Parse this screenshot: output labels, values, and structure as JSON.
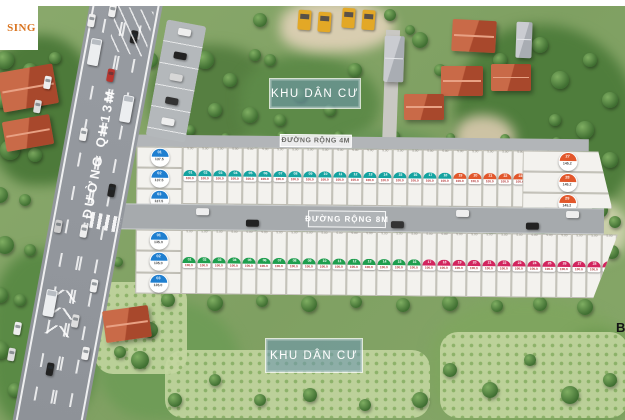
{
  "watermark": {
    "text": "SING"
  },
  "area_labels": {
    "residential_top": "KHU DÂN CƯ",
    "residential_bottom": "KHU DÂN CƯ"
  },
  "roads": {
    "main": "ĐƯỜNG QH13M",
    "internal_4m": "ĐƯỜNG RỘNG 4M",
    "internal_8m": "ĐƯỜNG RỘNG 8M"
  },
  "map_note": {
    "corner_letter": "B"
  },
  "lot_dimensions": {
    "frontage": "5.00",
    "depth": "20.0"
  },
  "palette": {
    "teal": "#14a3a0",
    "orange": "#e2572b",
    "green": "#1f9e4e",
    "pink": "#d2255e",
    "blue": "#1f7fd0",
    "area_text": "#b03030"
  },
  "blocks": {
    "upper": {
      "left_lots": [
        {
          "id": "01",
          "area": "137.5"
        },
        {
          "id": "02",
          "area": "137.5"
        },
        {
          "id": "03",
          "area": "137.5"
        }
      ],
      "row_lots": [
        {
          "id": "01",
          "area": "100.0",
          "color": "teal"
        },
        {
          "id": "02",
          "area": "100.0",
          "color": "teal"
        },
        {
          "id": "03",
          "area": "100.0",
          "color": "teal"
        },
        {
          "id": "04",
          "area": "100.0",
          "color": "teal"
        },
        {
          "id": "05",
          "area": "100.0",
          "color": "teal"
        },
        {
          "id": "06",
          "area": "100.0",
          "color": "teal"
        },
        {
          "id": "07",
          "area": "100.0",
          "color": "teal"
        },
        {
          "id": "08",
          "area": "100.0",
          "color": "teal"
        },
        {
          "id": "09",
          "area": "100.0",
          "color": "teal"
        },
        {
          "id": "10",
          "area": "100.0",
          "color": "teal"
        },
        {
          "id": "11",
          "area": "100.0",
          "color": "teal"
        },
        {
          "id": "12",
          "area": "100.0",
          "color": "teal"
        },
        {
          "id": "13",
          "area": "100.0",
          "color": "teal"
        },
        {
          "id": "14",
          "area": "100.0",
          "color": "teal"
        },
        {
          "id": "15",
          "area": "100.0",
          "color": "teal"
        },
        {
          "id": "16",
          "area": "100.0",
          "color": "teal"
        },
        {
          "id": "17",
          "area": "100.0",
          "color": "teal"
        },
        {
          "id": "18",
          "area": "100.0",
          "color": "teal"
        },
        {
          "id": "19",
          "area": "100.0",
          "color": "orange"
        },
        {
          "id": "20",
          "area": "100.0",
          "color": "orange"
        },
        {
          "id": "21",
          "area": "100.0",
          "color": "orange"
        },
        {
          "id": "22",
          "area": "100.0",
          "color": "orange"
        },
        {
          "id": "23",
          "area": "100.0",
          "color": "orange"
        },
        {
          "id": "24",
          "area": "100.0",
          "color": "orange"
        },
        {
          "id": "25",
          "area": "100.0",
          "color": "orange"
        },
        {
          "id": "26",
          "area": "100.0",
          "color": "orange"
        }
      ],
      "right_lots": [
        {
          "id": "27",
          "area": "145.2"
        },
        {
          "id": "28",
          "area": "145.2"
        },
        {
          "id": "29",
          "area": "145.2"
        }
      ]
    },
    "lower": {
      "left_lots": [
        {
          "id": "01",
          "area": "135.0"
        },
        {
          "id": "02",
          "area": "135.0"
        },
        {
          "id": "03",
          "area": "135.0"
        }
      ],
      "row_lots": [
        {
          "id": "01",
          "area": "100.0",
          "color": "green"
        },
        {
          "id": "02",
          "area": "100.0",
          "color": "green"
        },
        {
          "id": "03",
          "area": "100.0",
          "color": "green"
        },
        {
          "id": "04",
          "area": "100.0",
          "color": "green"
        },
        {
          "id": "05",
          "area": "100.0",
          "color": "green"
        },
        {
          "id": "06",
          "area": "100.0",
          "color": "green"
        },
        {
          "id": "07",
          "area": "100.0",
          "color": "green"
        },
        {
          "id": "08",
          "area": "100.0",
          "color": "green"
        },
        {
          "id": "09",
          "area": "100.0",
          "color": "green"
        },
        {
          "id": "10",
          "area": "100.0",
          "color": "green"
        },
        {
          "id": "11",
          "area": "100.0",
          "color": "green"
        },
        {
          "id": "12",
          "area": "100.0",
          "color": "green"
        },
        {
          "id": "13",
          "area": "100.0",
          "color": "green"
        },
        {
          "id": "14",
          "area": "100.0",
          "color": "green"
        },
        {
          "id": "15",
          "area": "100.0",
          "color": "green"
        },
        {
          "id": "16",
          "area": "100.0",
          "color": "green"
        },
        {
          "id": "17",
          "area": "100.0",
          "color": "pink"
        },
        {
          "id": "18",
          "area": "100.0",
          "color": "pink"
        },
        {
          "id": "19",
          "area": "100.0",
          "color": "pink"
        },
        {
          "id": "20",
          "area": "100.0",
          "color": "pink"
        },
        {
          "id": "21",
          "area": "100.0",
          "color": "pink"
        },
        {
          "id": "22",
          "area": "100.0",
          "color": "pink"
        },
        {
          "id": "23",
          "area": "100.0",
          "color": "pink"
        },
        {
          "id": "24",
          "area": "100.0",
          "color": "pink"
        },
        {
          "id": "25",
          "area": "100.0",
          "color": "pink"
        },
        {
          "id": "26",
          "area": "100.0",
          "color": "pink"
        },
        {
          "id": "27",
          "area": "100.0",
          "color": "pink"
        },
        {
          "id": "28",
          "area": "100.0",
          "color": "pink"
        },
        {
          "id": "29",
          "area": "100.0",
          "color": "pink"
        },
        {
          "id": "30",
          "area": "158.5",
          "color": "pink",
          "wide": true
        }
      ]
    }
  }
}
